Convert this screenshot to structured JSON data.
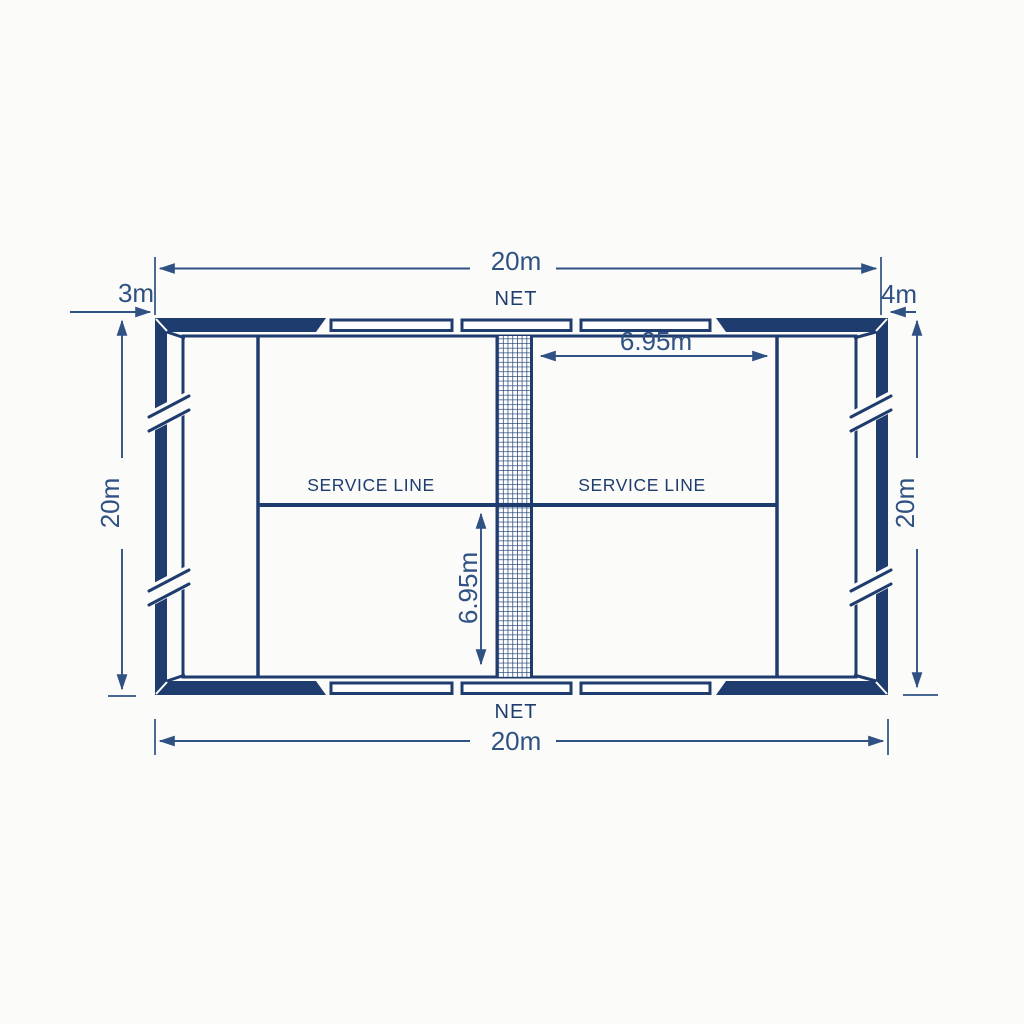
{
  "meta": {
    "title": "Court top-view dimension diagram"
  },
  "colors": {
    "line": "#1f3c6e",
    "dim": "#2f5183",
    "bg": "#fbfbf9"
  },
  "dims": {
    "top_width": "20m",
    "bottom_width": "20m",
    "left_length": "20m",
    "right_length": "20m",
    "left_wall_height": "3m",
    "right_wall_height": "4m",
    "net_to_service": "6.95m",
    "service_to_back": "6.95m"
  },
  "labels": {
    "net_top": "NET",
    "net_bottom": "NET",
    "service_line_left": "SERVICE LINE",
    "service_line_right": "SERVICE LINE"
  }
}
